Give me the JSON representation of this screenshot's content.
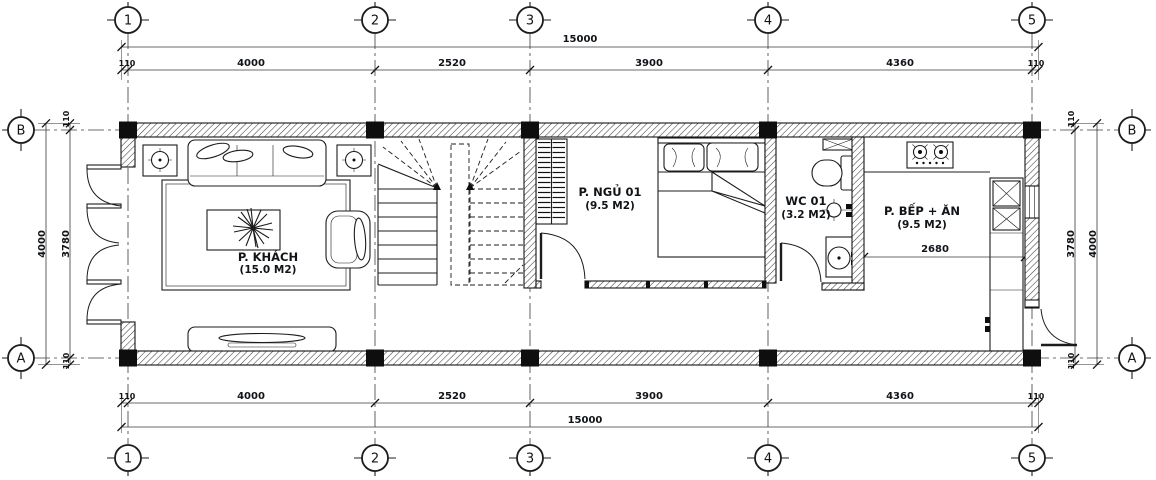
{
  "type": "floor-plan",
  "grid": {
    "columns": [
      "1",
      "2",
      "3",
      "4",
      "5"
    ],
    "rows": [
      "B",
      "A"
    ]
  },
  "dimensions": {
    "top": {
      "overall": "15000",
      "segments": [
        "110",
        "4000",
        "2520",
        "3900",
        "4360",
        "110"
      ]
    },
    "bottom": {
      "overall": "15000",
      "segments": [
        "110",
        "4000",
        "2520",
        "3900",
        "4360",
        "110"
      ]
    },
    "left": {
      "overall": "4000",
      "inner": "3780",
      "edge_top": "110",
      "edge_bottom": "110"
    },
    "right": {
      "overall": "4000",
      "inner": "3780",
      "edge_top": "110",
      "edge_bottom": "110"
    },
    "kitchen_width": "2680"
  },
  "rooms": {
    "living": {
      "name": "P. KHÁCH",
      "area": "(15.0 M2)"
    },
    "bedroom": {
      "name": "P. NGỦ 01",
      "area": "(9.5 M2)"
    },
    "wc": {
      "name": "WC 01",
      "area": "(3.2 M2)"
    },
    "kitchen": {
      "name": "P. BẾP + ĂN",
      "area": "(9.5 M2)"
    }
  },
  "colors": {
    "line": "#1c1c1c",
    "text": "#101418",
    "background": "#ffffff"
  }
}
